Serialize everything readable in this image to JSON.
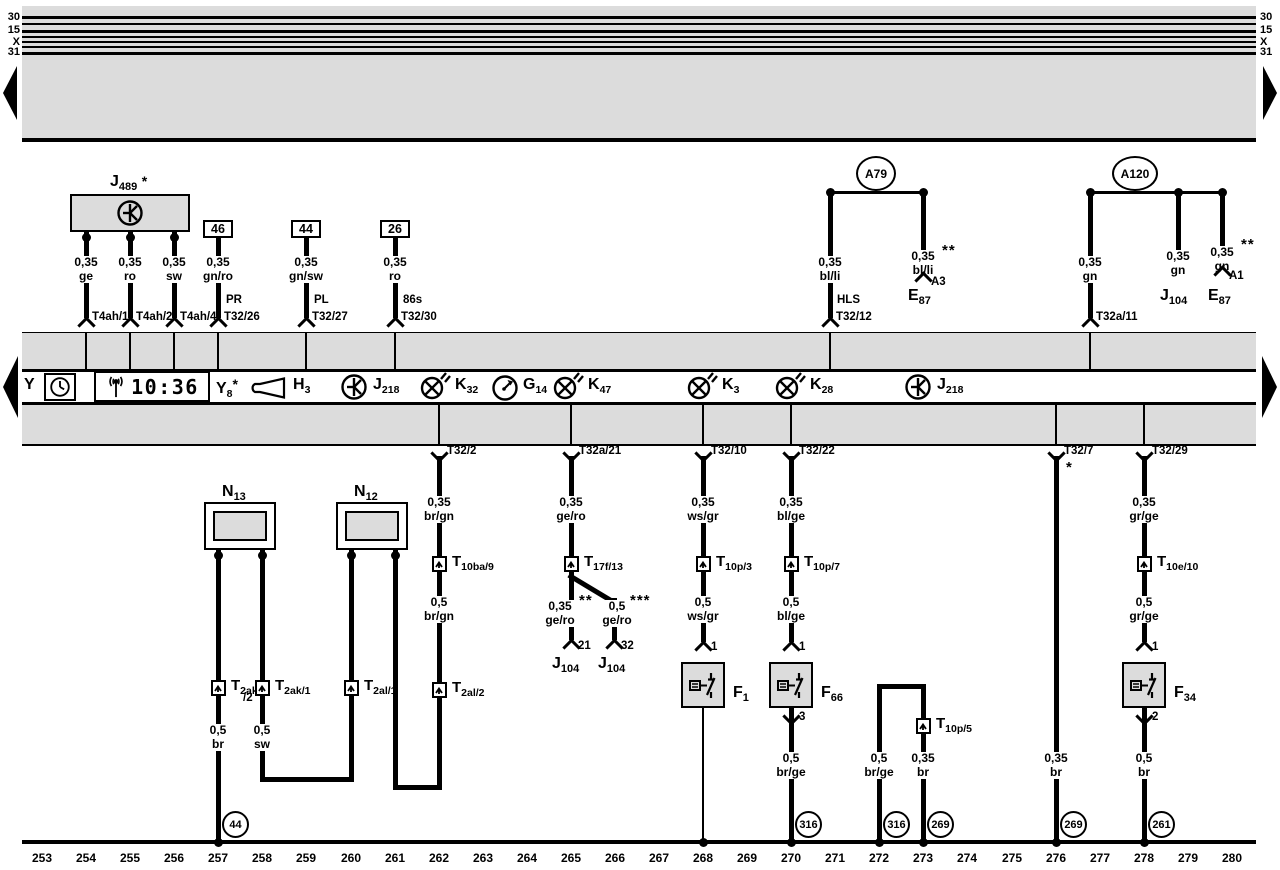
{
  "side_rails": {
    "left": [
      "30",
      "15",
      "X",
      "31"
    ],
    "right": [
      "30",
      "15",
      "X",
      "31"
    ]
  },
  "strip": {
    "y_label": "Y",
    "clock_time": "10:36",
    "y8": {
      "name": "Y",
      "sub": "8",
      "star": "*"
    },
    "h3": {
      "name": "H",
      "sub": "3"
    },
    "j218_left": {
      "name": "J",
      "sub": "218"
    },
    "k32": {
      "name": "K",
      "sub": "32"
    },
    "g14": {
      "name": "G",
      "sub": "14"
    },
    "k47": {
      "name": "K",
      "sub": "47"
    },
    "k3": {
      "name": "K",
      "sub": "3"
    },
    "k28": {
      "name": "K",
      "sub": "28"
    },
    "j218_right": {
      "name": "J",
      "sub": "218"
    }
  },
  "j489": {
    "name": "J",
    "sub": "489",
    "star": "*",
    "wires": [
      {
        "size": "0,35",
        "color": "ge",
        "pin": "T4ah/1"
      },
      {
        "size": "0,35",
        "color": "ro",
        "pin": "T4ah/2"
      },
      {
        "size": "0,35",
        "color": "sw",
        "pin": "T4ah/4"
      }
    ]
  },
  "plugs": [
    {
      "num": "46",
      "size": "0,35",
      "color": "gn/ro",
      "tag": "PR",
      "pin": "T32/26"
    },
    {
      "num": "44",
      "size": "0,35",
      "color": "gn/sw",
      "tag": "PL",
      "pin": "T32/27"
    },
    {
      "num": "26",
      "size": "0,35",
      "color": "ro",
      "tag": "86s",
      "pin": "T32/30"
    }
  ],
  "a79": {
    "label": "A79",
    "left": {
      "size": "0,35",
      "color": "bl/li",
      "tag": "HLS",
      "pin": "T32/12"
    },
    "right": {
      "size": "0,35",
      "color": "bl/li",
      "stars": "**",
      "pin": "A3",
      "dev": "E",
      "dev_sub": "87"
    }
  },
  "a120": {
    "label": "A120",
    "left": {
      "size": "0,35",
      "color": "gn",
      "pin": "T32a/11"
    },
    "mid": {
      "size": "0,35",
      "color": "gn",
      "dev": "J",
      "dev_sub": "104"
    },
    "right": {
      "size": "0,35",
      "color": "gn",
      "stars": "**",
      "pin": "A1",
      "dev": "E",
      "dev_sub": "87"
    }
  },
  "n13": {
    "name": "N",
    "sub": "13",
    "conn_left": {
      "t": "T",
      "sub": "2ak",
      "sub2": "/2"
    },
    "conn_right": {
      "t": "T",
      "sub": "2ak/1"
    },
    "wire_left": {
      "size": "0,5",
      "color": "br"
    },
    "wire_right": {
      "size": "0,5",
      "color": "sw"
    },
    "ground": "44"
  },
  "n12": {
    "name": "N",
    "sub": "12",
    "conn_left": {
      "t": "T",
      "sub": "2al/1"
    }
  },
  "col262": {
    "pin": "T32/2",
    "w1": {
      "size": "0,35",
      "color": "br/gn"
    },
    "conn": {
      "t": "T",
      "sub": "10ba/9"
    },
    "w2": {
      "size": "0,5",
      "color": "br/gn"
    },
    "conn2": {
      "t": "T",
      "sub": "2al/2"
    }
  },
  "col265": {
    "pin": "T32a/21",
    "w1": {
      "size": "0,35",
      "color": "ge/ro"
    },
    "conn": {
      "t": "T",
      "sub": "17f/13"
    },
    "left": {
      "size": "0,35",
      "stars": "**",
      "color": "ge/ro",
      "pin": "21",
      "dev": "J",
      "dev_sub": "104"
    },
    "right": {
      "size": "0,5",
      "stars": "***",
      "color": "ge/ro",
      "pin": "32",
      "dev": "J",
      "dev_sub": "104"
    }
  },
  "col268": {
    "pin": "T32/10",
    "w1": {
      "size": "0,35",
      "color": "ws/gr"
    },
    "conn": {
      "t": "T",
      "sub": "10p/3"
    },
    "w2": {
      "size": "0,5",
      "color": "ws/gr"
    },
    "pin_top": "1",
    "dev": {
      "name": "F",
      "sub": "1"
    }
  },
  "col270": {
    "pin": "T32/22",
    "w1": {
      "size": "0,35",
      "color": "bl/ge"
    },
    "conn": {
      "t": "T",
      "sub": "10p/7"
    },
    "w2": {
      "size": "0,5",
      "color": "bl/ge"
    },
    "pin_top": "1",
    "dev": {
      "name": "F",
      "sub": "66"
    },
    "pin_bot": "3",
    "w3": {
      "size": "0,5",
      "color": "br/ge"
    },
    "ground": "316"
  },
  "bridge": {
    "left": {
      "size": "0,5",
      "color": "br/ge",
      "ground": "316"
    },
    "right": {
      "conn": {
        "t": "T",
        "sub": "10p/5"
      },
      "size": "0,35",
      "color": "br",
      "ground": "269"
    }
  },
  "col276": {
    "pin": "T32/7",
    "star": "*",
    "w": {
      "size": "0,35",
      "color": "br"
    },
    "ground": "269"
  },
  "col278": {
    "pin": "T32/29",
    "w1": {
      "size": "0,35",
      "color": "gr/ge"
    },
    "conn": {
      "t": "T",
      "sub": "10e/10"
    },
    "w2": {
      "size": "0,5",
      "color": "gr/ge"
    },
    "pin_top": "1",
    "dev": {
      "name": "F",
      "sub": "34"
    },
    "pin_bot": "2",
    "w3": {
      "size": "0,5",
      "color": "br"
    },
    "ground": "261"
  },
  "tracks": [
    "253",
    "254",
    "255",
    "256",
    "257",
    "258",
    "259",
    "260",
    "261",
    "262",
    "263",
    "264",
    "265",
    "266",
    "267",
    "268",
    "269",
    "270",
    "271",
    "272",
    "273",
    "274",
    "275",
    "276",
    "277",
    "278",
    "279",
    "280"
  ]
}
